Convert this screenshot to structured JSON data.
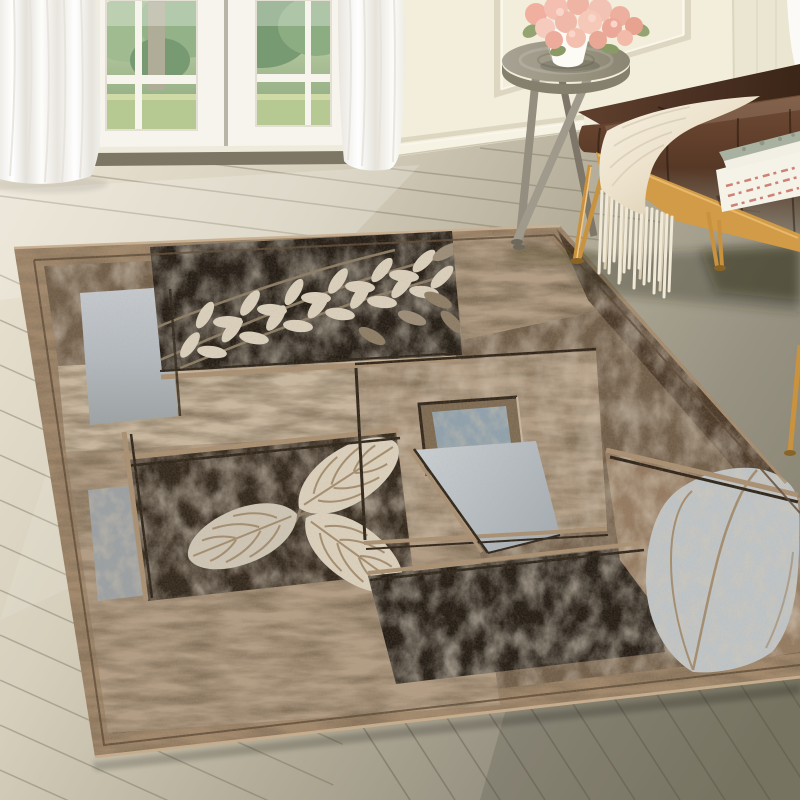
{
  "scene": {
    "setting": "living-room product photo",
    "items": [
      "sheer-curtains",
      "french-door",
      "paneled-wall",
      "wood-floor",
      "tripod-stool",
      "rose-bouquet",
      "white-vase",
      "leather-bench",
      "throw-blanket",
      "blanket-fringe",
      "stacked-books",
      "patchwork-area-rug",
      "branch-leaf-motif",
      "leaf-trio-motif",
      "big-leaf-motif",
      "window-motif"
    ]
  },
  "colors": {
    "wall": "#f2eedb",
    "wall_right": "#ebe6d1",
    "baseboard": "#f6f3e4",
    "molding": "#ddd7c2",
    "molding_hi": "#faf7ea",
    "door": "#f6f4ed",
    "door_frame": "#efece1",
    "door_gap": "#b8b4a6",
    "sill": "#eeebdd",
    "threshold": "#7e7665",
    "glass_leaf_dark": "#5e8757",
    "glass_leaf_light": "#8fae7c",
    "glass_grass": "#aabf7e",
    "glass_trunk": "#a09c85",
    "curtain": "#fbfaf6",
    "curtain_fold": "#e6e3dc",
    "floor_light": "#ebe4d4",
    "floor_mid": "#c4bdab",
    "floor_dark": "#84806d",
    "plank_line": "#6d6450",
    "stool_top": "#9b968b",
    "stool_side": "#857f6e",
    "stool_leg": "#948e80",
    "vase": "#fcfbf5",
    "rose": "#f2b9a9",
    "rose_deep": "#e9a28e",
    "rose_pale": "#f7cfc2",
    "rose_leaf": "#93a371",
    "bench_top": "#4f3526",
    "bench_front": "#5f4030",
    "bench_dark": "#342216",
    "bench_rail": "#d29b47",
    "bench_leg_gold": "#c8923f",
    "blanket": "#f1e9d8",
    "blanket_deep": "#dbcfb6",
    "book_pages": "#f5f2e7",
    "book_cover": "#a9b1a0",
    "book_text": "#ce8175",
    "rug_border": "#a1876a",
    "rug_border_hi": "#c7ad8d",
    "rug_border_line": "#5e4a35",
    "rug_field": "#6f5c47",
    "rug_black": "#221b13",
    "rug_dark_panel": "#31261a",
    "rug_dark_strip": "#4a3827",
    "rug_beige": "#b29c83",
    "rug_beige_light": "#c9b79e",
    "rug_gray": "#b9bec3",
    "rug_gray_dark": "#9ba0a3",
    "rug_window": "#8fa1ad",
    "rug_window_bevel": "#7d6950",
    "rug_taupe": "#93795f",
    "rug_leaf": "#dbd1bd",
    "rug_leaf_dark": "#8d7c64",
    "rug_leaf_vein": "#a38c6e",
    "rug_big_leaf": "#bfc5c8",
    "rug_ridge": "#a98f71",
    "rug_ridge_dark": "#2c2216",
    "shadow": "rgba(45,36,25,0.32)"
  }
}
